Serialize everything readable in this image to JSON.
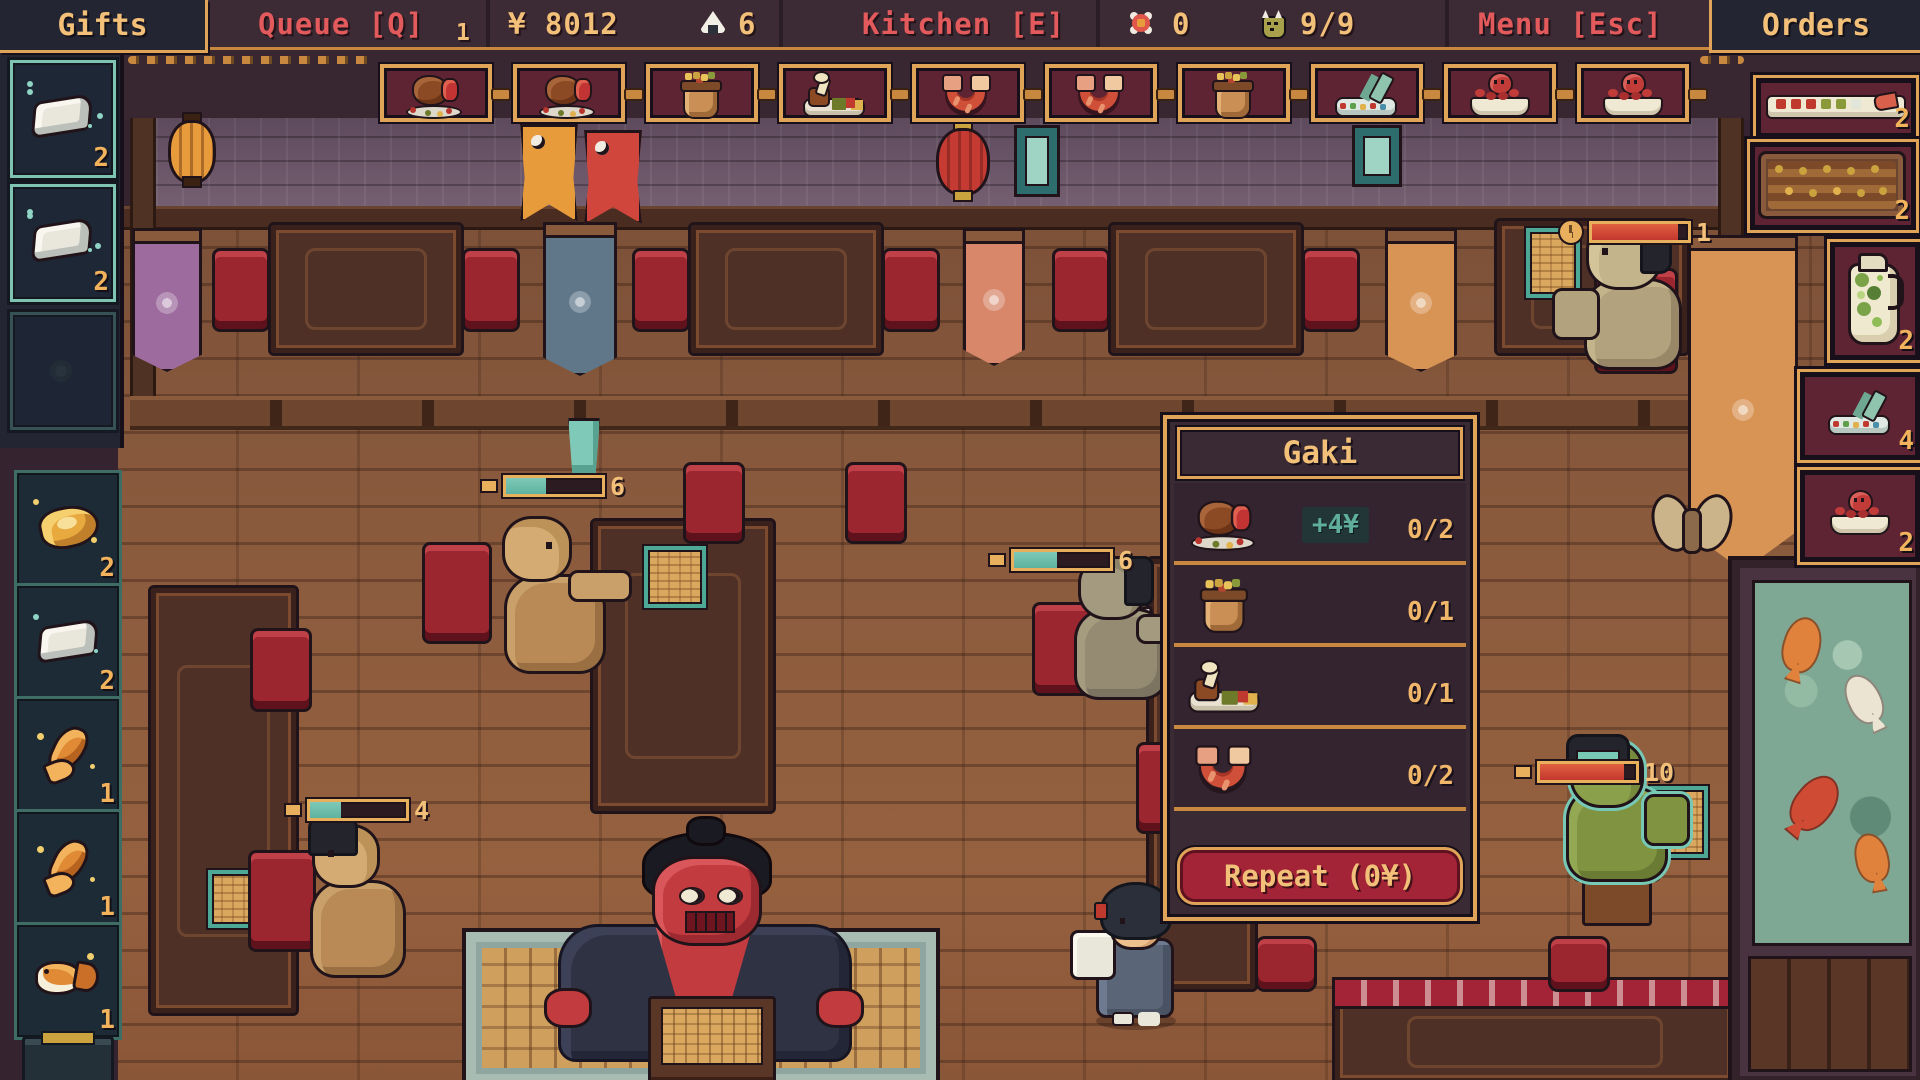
{
  "hud": {
    "gifts_label": "Gifts",
    "queue_label": "Queue [Q]",
    "queue_count": "1",
    "money": "¥ 8012",
    "rice_ball_icon": "rice-ball",
    "rice_ball_count": "6",
    "kitchen_label": "Kitchen [E]",
    "blossom_icon": "blossom",
    "blossom_count": "0",
    "mask_icon": "oni-mask",
    "mask_count": "9/9",
    "menu_label": "Menu [Esc]",
    "orders_label": "Orders"
  },
  "queue_row": {
    "items": [
      {
        "icon": "roast-turkey"
      },
      {
        "icon": "roast-turkey"
      },
      {
        "icon": "clay-pot"
      },
      {
        "icon": "drumstick-plate"
      },
      {
        "icon": "fried-shrimp"
      },
      {
        "icon": "fried-shrimp"
      },
      {
        "icon": "clay-pot"
      },
      {
        "icon": "sashimi-plate"
      },
      {
        "icon": "octopus-dish"
      },
      {
        "icon": "octopus-dish"
      }
    ]
  },
  "gifts_panel": {
    "slots": [
      {
        "icon": "silver-wedge",
        "count": "2"
      },
      {
        "icon": "silver-wedge",
        "count": "2"
      },
      {
        "icon": "empty-slot",
        "count": ""
      }
    ]
  },
  "prize_stand": {
    "slots": [
      {
        "icon": "gold-loaf",
        "count": "2"
      },
      {
        "icon": "silver-wedge",
        "count": "2"
      },
      {
        "icon": "koi-tail",
        "count": "1"
      },
      {
        "icon": "koi-tail",
        "count": "1"
      },
      {
        "icon": "goldfish",
        "count": "1"
      }
    ]
  },
  "orders_panel": {
    "items": [
      {
        "icon": "sushi-platter",
        "count": "2"
      },
      {
        "icon": "skewer-tray",
        "count": "2"
      },
      {
        "icon": "sake-pitcher",
        "count": "2"
      },
      {
        "icon": "sashimi-plate",
        "count": "4"
      },
      {
        "icon": "octopus-dish",
        "count": "2"
      }
    ]
  },
  "order_panel": {
    "title": "Gaki",
    "rows": [
      {
        "icon": "roast-turkey",
        "bonus": "+4¥",
        "count": "0/2"
      },
      {
        "icon": "clay-pot",
        "bonus": "",
        "count": "0/1"
      },
      {
        "icon": "drumstick-plate",
        "bonus": "",
        "count": "0/1"
      },
      {
        "icon": "fried-shrimp",
        "bonus": "",
        "count": "0/2"
      }
    ],
    "repeat_label": "Repeat (0¥)"
  },
  "patience_bars": [
    {
      "value": "6",
      "color": "#5fb2a0"
    },
    {
      "value": "6",
      "color": "#5fb2a0"
    },
    {
      "value": "4",
      "color": "#5fb2a0"
    },
    {
      "value": "10",
      "color": "#c4372e"
    },
    {
      "value": "1",
      "color": "#c4372e"
    }
  ],
  "colors": {
    "hud_bg": "#3c2a34",
    "hud_red": "#e25a5c",
    "hud_gold": "#f2c078",
    "card_bg": "#5e2433",
    "gold_border": "#e0a458",
    "panel_navy": "#232533",
    "teal": "#64b4a4",
    "crimson": "#a32337",
    "floor": "#8a5a3d"
  }
}
